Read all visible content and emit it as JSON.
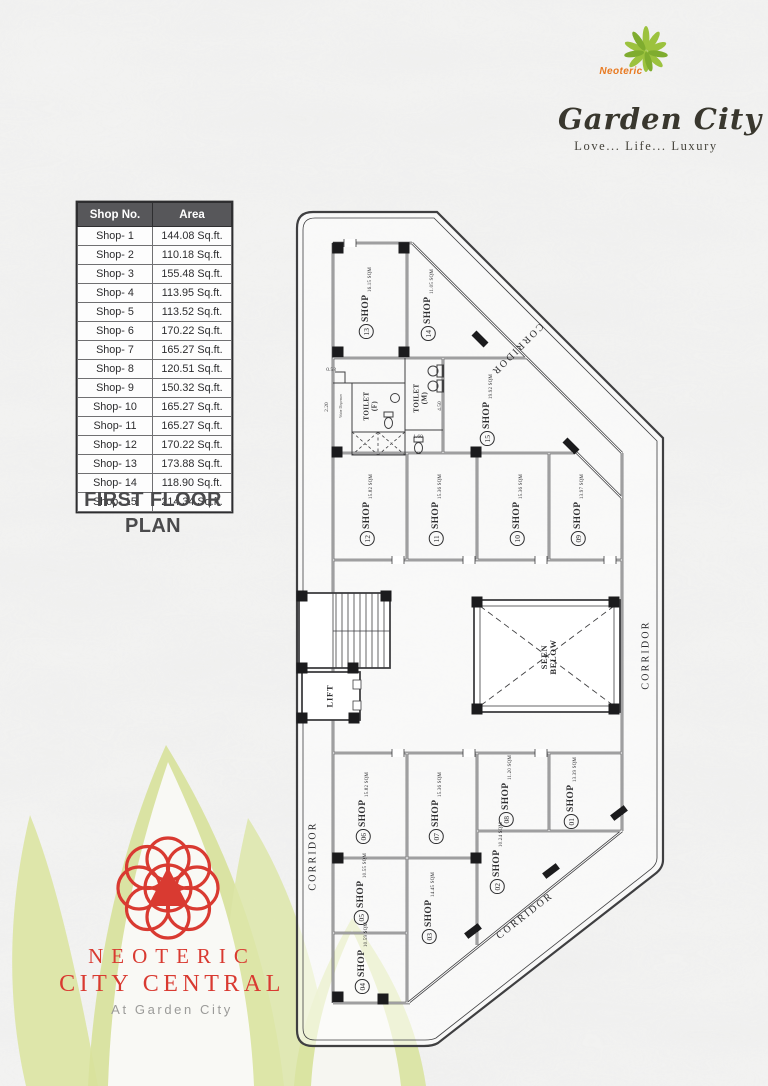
{
  "header_logo": {
    "brand_pre": "Neoteric",
    "brand_name": "Garden City",
    "tagline": "Love... Life... Luxury"
  },
  "area_table": {
    "headers": [
      "Shop No.",
      "Area"
    ],
    "rows": [
      [
        "Shop- 1",
        "144.08 Sq.ft."
      ],
      [
        "Shop- 2",
        "110.18 Sq.ft."
      ],
      [
        "Shop- 3",
        "155.48 Sq.ft."
      ],
      [
        "Shop- 4",
        "113.95 Sq.ft."
      ],
      [
        "Shop- 5",
        "113.52 Sq.ft."
      ],
      [
        "Shop- 6",
        "170.22 Sq.ft."
      ],
      [
        "Shop- 7",
        "165.27 Sq.ft."
      ],
      [
        "Shop- 8",
        "120.51 Sq.ft."
      ],
      [
        "Shop- 9",
        "150.32 Sq.ft."
      ],
      [
        "Shop- 10",
        "165.27 Sq.ft."
      ],
      [
        "Shop- 11",
        "165.27 Sq.ft."
      ],
      [
        "Shop- 12",
        "170.22 Sq.ft."
      ],
      [
        "Shop- 13",
        "173.88 Sq.ft."
      ],
      [
        "Shop- 14",
        "118.90 Sq.ft."
      ],
      [
        "Shop- 15",
        "214.34 Sq.ft."
      ]
    ]
  },
  "plan_title": "FIRST FLOOR PLAN",
  "floor_plan": {
    "shop_word": "SHOP",
    "shops": [
      {
        "num": "01",
        "sqm": "13.39 SQM",
        "x": 571,
        "y": 793,
        "rot": -90
      },
      {
        "num": "02",
        "sqm": "10.24 SQM",
        "x": 497,
        "y": 858,
        "rot": -90
      },
      {
        "num": "03",
        "sqm": "14.45 SQM",
        "x": 429,
        "y": 908,
        "rot": -90
      },
      {
        "num": "04",
        "sqm": "10.59 SQM",
        "x": 362,
        "y": 958,
        "rot": -90
      },
      {
        "num": "05",
        "sqm": "10.55 SQM",
        "x": 361,
        "y": 889,
        "rot": -90
      },
      {
        "num": "06",
        "sqm": "15.82 SQM",
        "x": 363,
        "y": 808,
        "rot": -90
      },
      {
        "num": "07",
        "sqm": "15.36 SQM",
        "x": 436,
        "y": 808,
        "rot": -90
      },
      {
        "num": "08",
        "sqm": "11.20 SQM",
        "x": 506,
        "y": 791,
        "rot": -90
      },
      {
        "num": "09",
        "sqm": "13.97 SQM",
        "x": 578,
        "y": 510,
        "rot": -90
      },
      {
        "num": "10",
        "sqm": "15.36 SQM",
        "x": 517,
        "y": 510,
        "rot": -90
      },
      {
        "num": "11",
        "sqm": "15.36 SQM",
        "x": 436,
        "y": 510,
        "rot": -90
      },
      {
        "num": "12",
        "sqm": "15.82 SQM",
        "x": 367,
        "y": 510,
        "rot": -90
      },
      {
        "num": "13",
        "sqm": "16.15 SQM",
        "x": 366,
        "y": 303,
        "rot": -90
      },
      {
        "num": "14",
        "sqm": "11.05 SQM",
        "x": 428,
        "y": 305,
        "rot": -90
      },
      {
        "num": "15",
        "sqm": "19.92 SQM",
        "x": 487,
        "y": 410,
        "rot": -90
      }
    ],
    "corridors": [
      {
        "text": "CORRIDOR",
        "x": 517,
        "y": 349,
        "rot": 135
      },
      {
        "text": "CORRIDOR",
        "x": 646,
        "y": 655,
        "rot": -90
      },
      {
        "text": "CORRIDOR",
        "x": 313,
        "y": 856,
        "rot": -90
      },
      {
        "text": "CORRIDOR",
        "x": 525,
        "y": 916,
        "rot": -38
      }
    ],
    "rooms": [
      {
        "kind": "toilet",
        "text": "TOILET\n(F)",
        "x": 371,
        "y": 406,
        "rot": -90
      },
      {
        "kind": "toilet",
        "text": "TOILET\n(M)",
        "x": 421,
        "y": 398,
        "rot": -90
      },
      {
        "kind": "lift",
        "text": "LIFT",
        "x": 330,
        "y": 696,
        "rot": -90
      },
      {
        "kind": "seen",
        "text": "SEEN\nBELOW",
        "x": 549,
        "y": 657,
        "rot": -90
      },
      {
        "kind": "note",
        "text": "Water Dispenser",
        "x": 342,
        "y": 406,
        "rot": -90
      }
    ],
    "dims": [
      {
        "text": "2.20",
        "x": 327,
        "y": 407,
        "rot": -90
      },
      {
        "text": "0.58",
        "x": 331,
        "y": 370,
        "rot": 0
      },
      {
        "text": "1.60",
        "x": 418,
        "y": 437,
        "rot": 0
      },
      {
        "text": "4.50",
        "x": 440,
        "y": 406,
        "rot": -90
      }
    ]
  },
  "footer_logo": {
    "line1": "NEOTERIC",
    "line2": "CITY CENTRAL",
    "tagline": "At Garden City"
  },
  "colors": {
    "accent_red": "#D93A31",
    "accent_orange": "#E87A22",
    "leaf_green": "#8CB83A",
    "pale_leaf": "#DCE5A5",
    "table_header_bg": "#57575A",
    "ink": "#3F3F41"
  }
}
